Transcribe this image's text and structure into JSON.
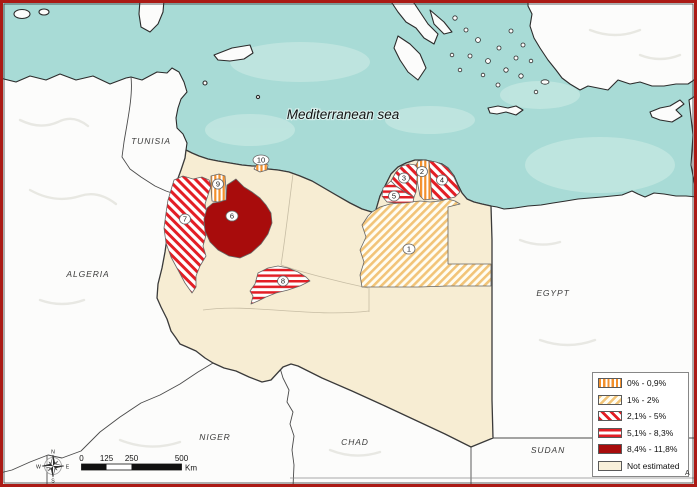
{
  "sea": {
    "label": "Mediterranean sea"
  },
  "countries": [
    {
      "name": "TUNISIA"
    },
    {
      "name": "ALGERIA"
    },
    {
      "name": "NIGER"
    },
    {
      "name": "CHAD"
    },
    {
      "name": "SUDAN"
    },
    {
      "name": "EGYPT"
    }
  ],
  "regions": [
    {
      "id": "1",
      "category": "1% - 2%"
    },
    {
      "id": "2",
      "category": "0% - 0,9%"
    },
    {
      "id": "3",
      "category": "2,1% - 5%"
    },
    {
      "id": "4",
      "category": "2,1% - 5%"
    },
    {
      "id": "5",
      "category": "5,1% - 8,3%"
    },
    {
      "id": "6",
      "category": "8,4% - 11,8%"
    },
    {
      "id": "7",
      "category": "2,1% - 5%"
    },
    {
      "id": "8",
      "category": "5,1% - 8,3%"
    },
    {
      "id": "9",
      "category": "0% - 0,9%"
    },
    {
      "id": "10",
      "category": "0% - 0,9%"
    }
  ],
  "legend": {
    "items": [
      {
        "label": "0% - 0,9%",
        "pattern": "orange-vertical-stripes"
      },
      {
        "label": "1% - 2%",
        "pattern": "yellow-diagonal-stripes"
      },
      {
        "label": "2,1% - 5%",
        "pattern": "red-diagonal-stripes"
      },
      {
        "label": "5,1% - 8,3%",
        "pattern": "red-horizontal-stripes"
      },
      {
        "label": "8,4% - 11,8%",
        "pattern": "solid-dark-red"
      },
      {
        "label": "Not estimated",
        "pattern": "solid-cream"
      }
    ]
  },
  "scale_bar": {
    "ticks": [
      "0",
      "125",
      "250",
      "500"
    ],
    "unit": "Km"
  },
  "compass": {
    "north": "N",
    "east": "E",
    "south": "S",
    "west": "W"
  },
  "corner_note": "A",
  "colors": {
    "sea": "#a8dbd6",
    "outside_land": "#fcfcfb",
    "libya_not_estimated": "#f7edd3",
    "stripe_orange": "#f3902c",
    "stripe_yellow": "#f2c478",
    "stripe_red": "#e31e25",
    "solid_dark_red": "#a80c0c",
    "frame_red": "#ab1a15"
  }
}
